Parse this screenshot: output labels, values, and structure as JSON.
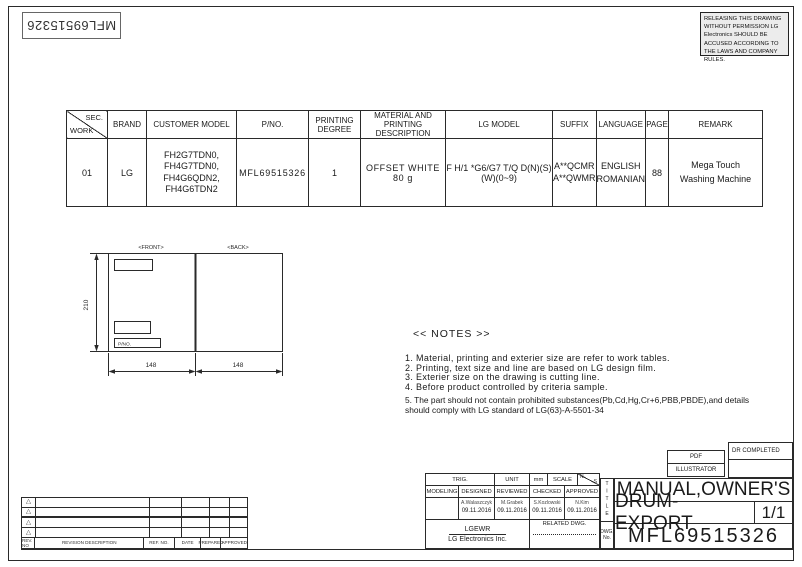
{
  "page": {
    "stamp_number": "MFL69515326",
    "warning_notice": "RELEASING THIS DRAWING WITHOUT PERMISSION LG Electronics SHOULD BE ACCUSED ACCORDING TO THE LAWS AND COMPANY RULES."
  },
  "spec_table": {
    "corner_top": "SEC.",
    "corner_bottom": "WORK",
    "headers": {
      "brand": "BRAND",
      "customer_model": "CUSTOMER MODEL",
      "pno": "P/NO.",
      "printing_degree": "PRINTING DEGREE",
      "material": "MATERIAL AND PRINTING DESCRIPTION",
      "lg_model": "LG MODEL",
      "suffix": "SUFFIX",
      "language": "LANGUAGE",
      "page": "PAGE",
      "remark": "REMARK"
    },
    "row": {
      "work": "01",
      "brand": "LG",
      "customer_model": [
        "FH2G7TDN0,",
        "FH4G7TDN0,",
        "FH4G6QDN2,",
        "FH4G6TDN2"
      ],
      "pno": "MFL69515326",
      "printing_degree": "1",
      "material": "OFFSET WHITE 80 g",
      "lg_model": "F H/1 *G6/G7 T/Q D(N)(S)(W)(0~9)",
      "suffix": [
        "A**QCMR",
        "A**QWMR"
      ],
      "language": [
        "ENGLISH",
        "ROMANIAN"
      ],
      "page": "88",
      "remark": [
        "Mega Touch",
        "Washing Machine"
      ]
    }
  },
  "drawing": {
    "front_label": "<FRONT>",
    "back_label": "<BACK>",
    "pno_box_label": "P/NO.",
    "height_dim": "210",
    "front_width_dim": "148",
    "back_width_dim": "148"
  },
  "notes": {
    "heading": "<< NOTES >>",
    "items": [
      "1. Material, printing and exterier size are refer to work tables.",
      "2. Printing, text size and line are based on LG design film.",
      "3. Exterier size on the drawing is cutting line.",
      "4. Before product controlled by criteria sample.",
      "5. The part should not contain prohibited substances(Pb,Cd,Hg,Cr+6,PBB,PBDE),and details\n    should comply with LG standard of LG(63)-A-5501-34"
    ]
  },
  "approval": {
    "trig": "TRIG.",
    "unit_label": "UNIT",
    "unit_value": "mm",
    "scale_label": "SCALE",
    "scale_top": "N",
    "scale_bottom": "S",
    "col_modeling": "MODELING",
    "col_designed": "DESIGNED",
    "col_reviewed": "REVIEWED",
    "col_checked": "CHECKED",
    "col_approved": "APPROVED",
    "designed_name": "A.Walaszczyk",
    "designed_date": "09.11.2016",
    "reviewed_name": "M.Grabek",
    "reviewed_date": "09.11.2016",
    "checked_name": "S.Kozlowski",
    "checked_date": "09.11.2016",
    "approved_name": "N.Kim",
    "approved_date": "09.11.2016",
    "company_short": "LGEWR",
    "company_full": "LG Electronics Inc.",
    "related_dwg_label": "RELATED DWG."
  },
  "title_block": {
    "title_vertical": "TITLE",
    "title_line1": "MANUAL,OWNER'S",
    "title_line2": "DRUM-EXPORT",
    "sheet": "1/1",
    "dwg_label": "DWG.",
    "no_label": "No.",
    "dwg_no": "MFL69515326"
  },
  "stamps": {
    "dr_completed": "DR COMPLETED",
    "pdf": "PDF",
    "illustrator": "ILLUSTRATOR"
  },
  "revision_table": {
    "rev_no": "REV. NO",
    "description": "REVISION DESCRIPTION",
    "ref_no": "REF. NO.",
    "date": "DATE",
    "prepared": "PREPARED",
    "approved": "APPROVED"
  }
}
